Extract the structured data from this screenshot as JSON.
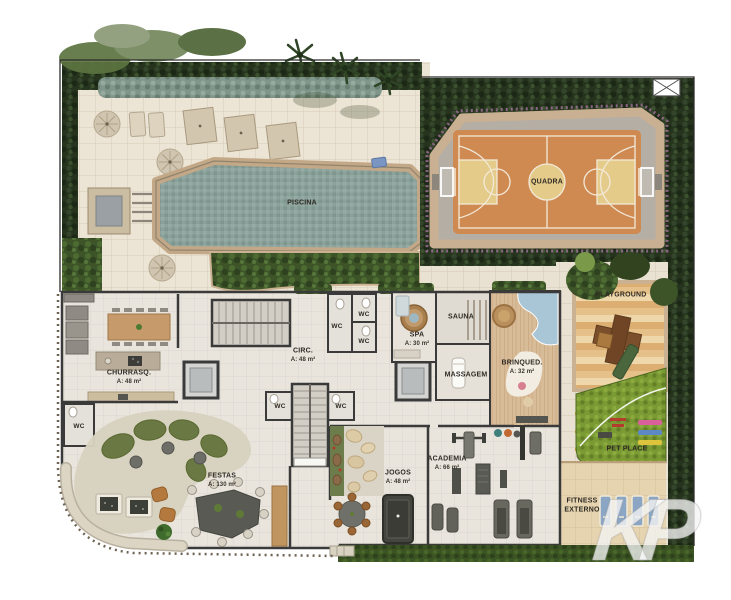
{
  "rooms": {
    "piscina": {
      "label": "PISCINA"
    },
    "quadra": {
      "label": "QUADRA"
    },
    "churrasqueira": {
      "label": "CHURRASQ.",
      "area": "A: 48 m²"
    },
    "circulacao": {
      "label": "CIRC.",
      "area": "A: 48 m²"
    },
    "spa": {
      "label": "SPA",
      "area": "A: 30 m²"
    },
    "sauna": {
      "label": "SAUNA"
    },
    "massagem": {
      "label": "MASSAGEM"
    },
    "brinquedoteca": {
      "label": "BRINQUED.",
      "area": "A: 32 m²"
    },
    "playground": {
      "label": "PLAYGROUND"
    },
    "pet_place": {
      "label": "PET PLACE"
    },
    "festas": {
      "label": "FESTAS",
      "area": "A: 130 m²"
    },
    "jogos": {
      "label": "JOGOS",
      "area": "A: 48 m²"
    },
    "academia": {
      "label": "ACADEMIA",
      "area": "A: 66 m²"
    },
    "fitness_externo": {
      "label": "FITNESS\nEXTERNO"
    }
  },
  "wc_label": "WC",
  "watermark": "KP",
  "colors": {
    "pool_water": "#8ba29b",
    "court_surface": "#cf8a52",
    "court_key": "#e4cb8a",
    "court_markings": "#f2e9d8",
    "deck_tile": "#ece4d4",
    "hedge": "#26331d",
    "grass": "#7a9a33",
    "playground_planks": "#dcae72",
    "pet_mat_pink": "#d9609b",
    "pet_mat_blue": "#5d88c6",
    "pet_mat_yellow": "#dec33c",
    "fitness_mat": "#8ba6c4",
    "wall": "#3a3a3a",
    "wood_floor": "#d8bb97"
  }
}
